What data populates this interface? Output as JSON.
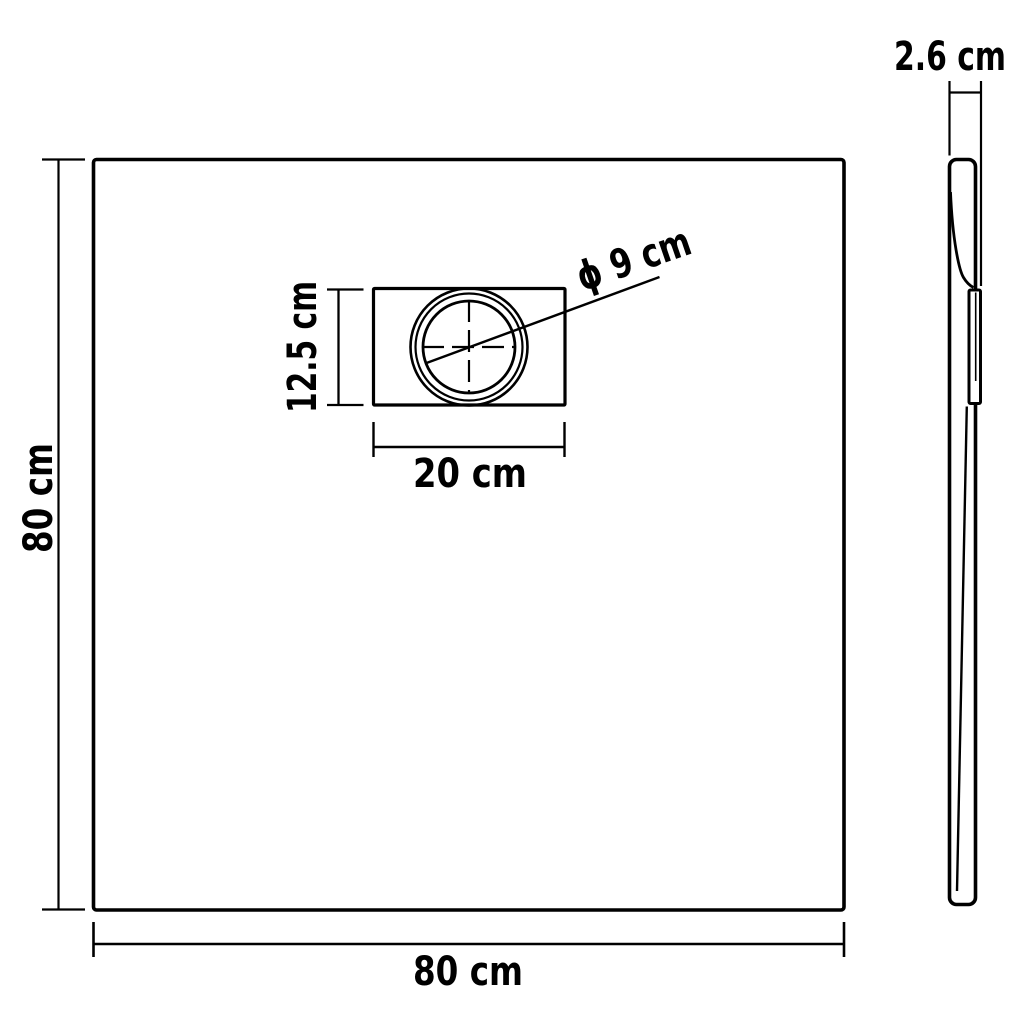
{
  "page": {
    "background_color": "#ffffff",
    "line_color": "#000000",
    "text_color": "#000000"
  },
  "dimensions": {
    "overall_depth_label": "80 cm",
    "overall_width_label": "80 cm",
    "thickness_label": "2.6 cm",
    "drain_plate_height_label": "12.5 cm",
    "drain_plate_width_label": "20 cm",
    "drain_diameter_label": "ϕ 9 cm"
  }
}
